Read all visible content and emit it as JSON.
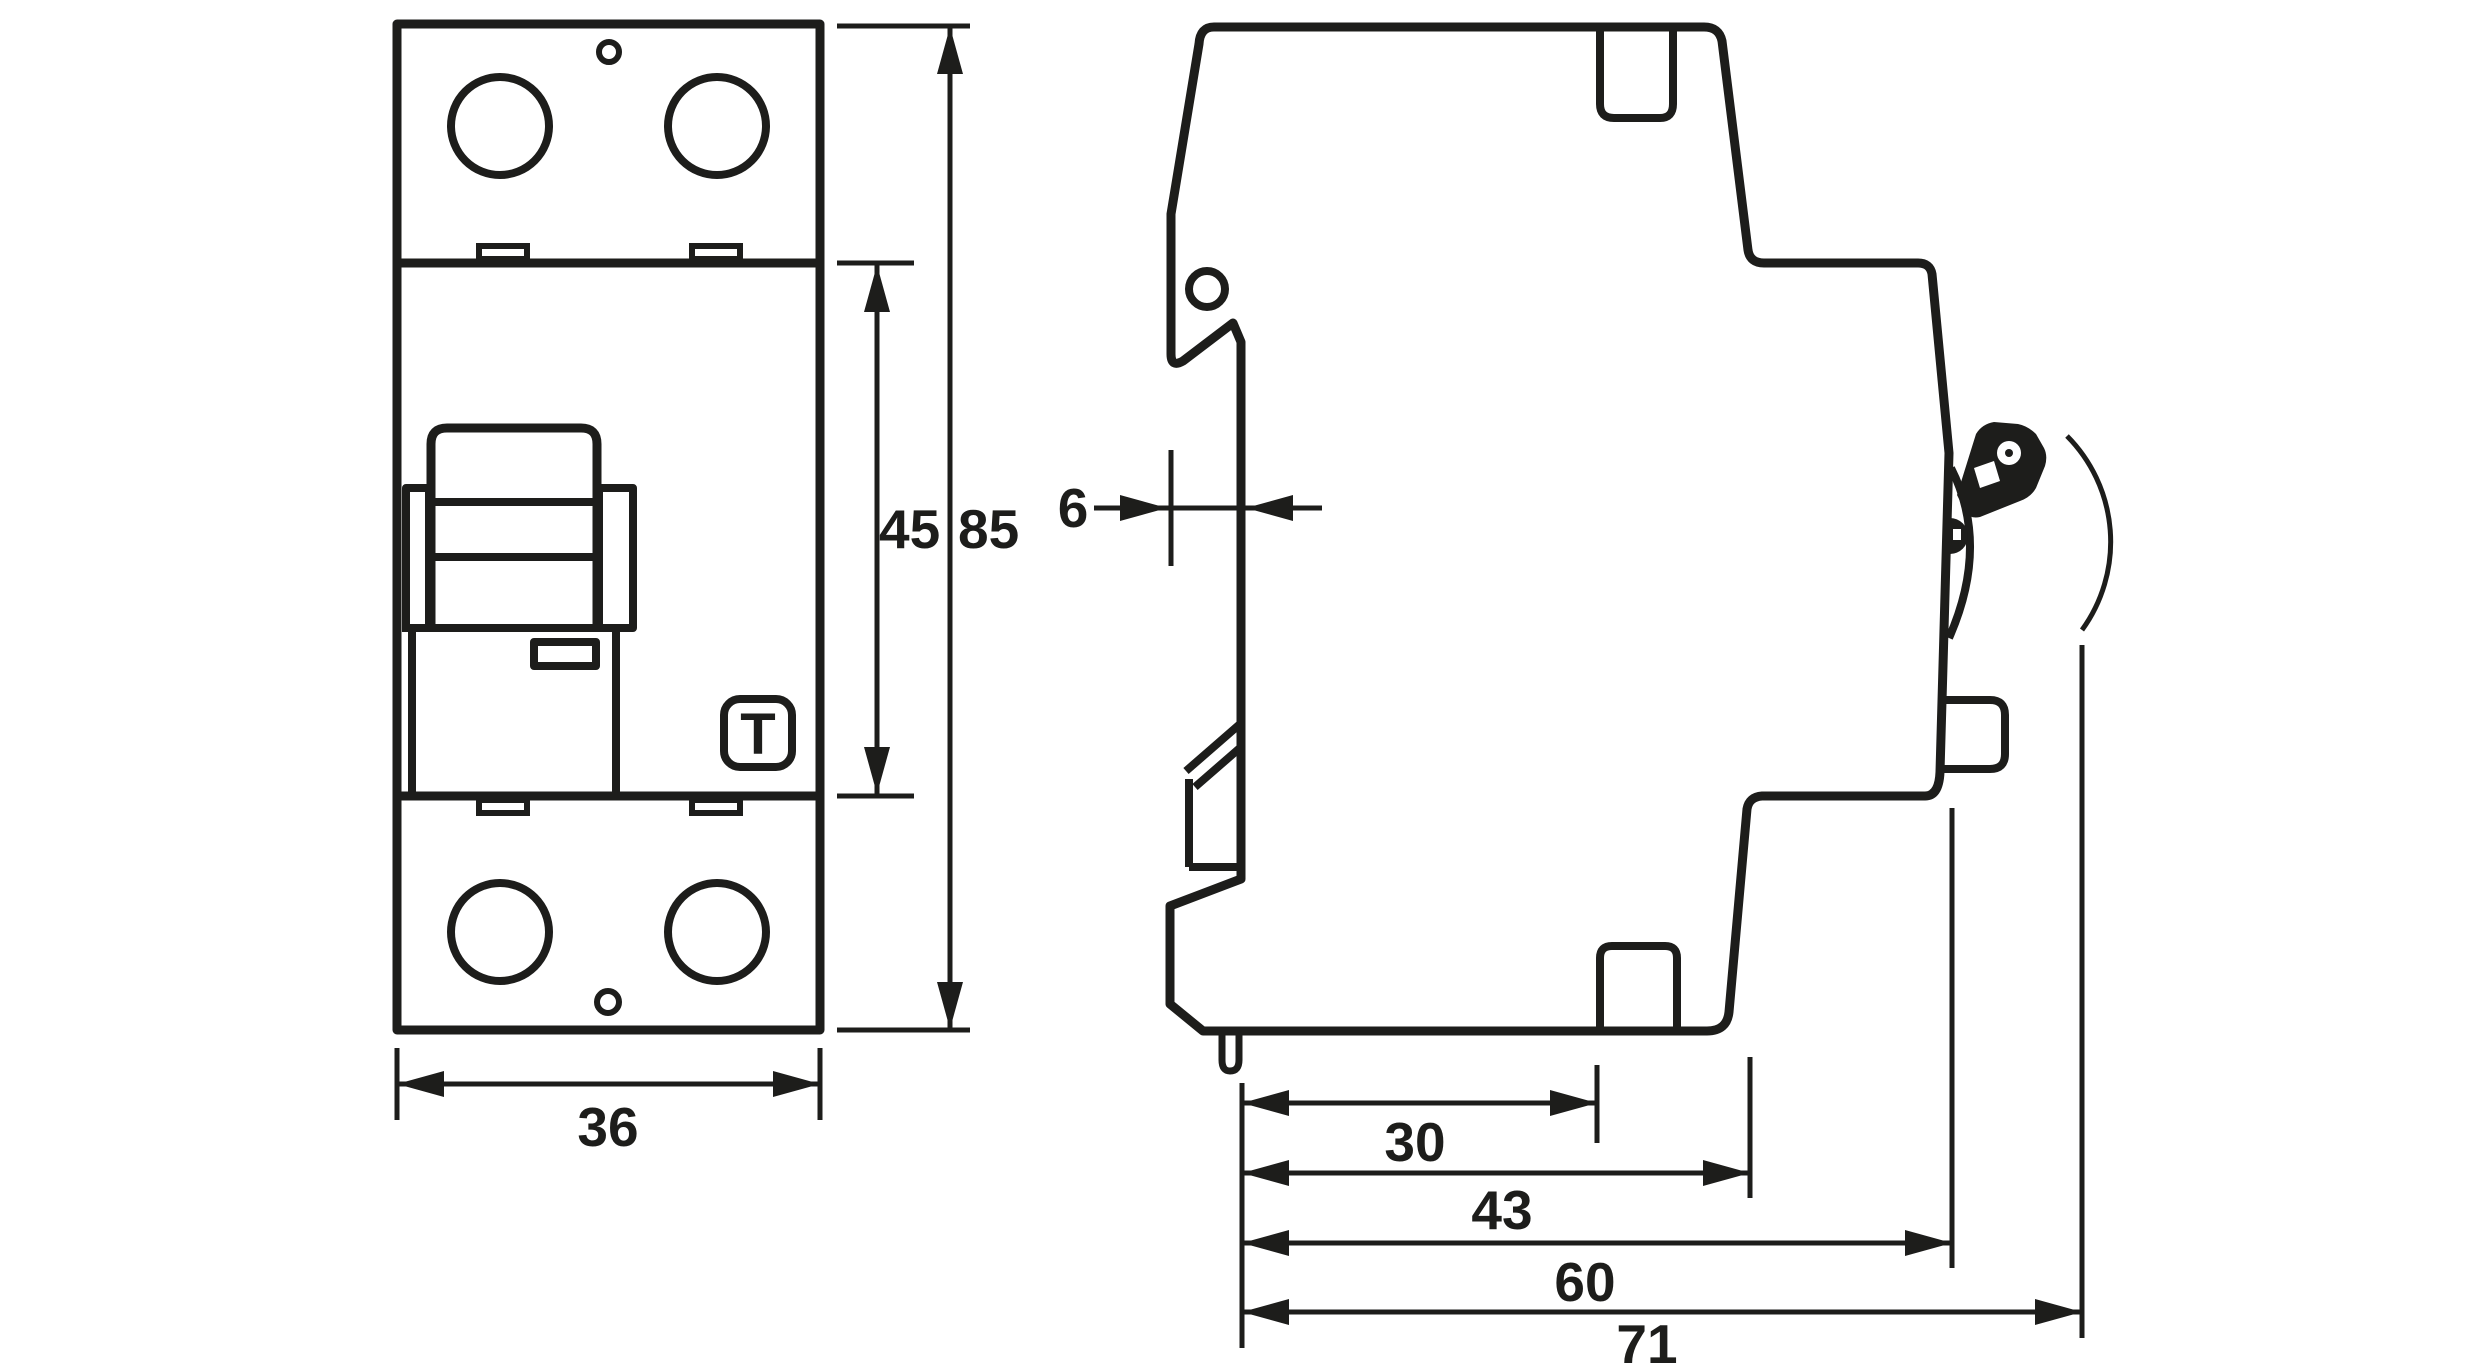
{
  "page": {
    "background": "#ffffff"
  },
  "drawing": {
    "line_color": "#1d1d1b",
    "front_view": {
      "test_button_label": "T"
    },
    "dimensions_mm": {
      "front_width": "36",
      "front_body_height": "45",
      "front_total_height": "85",
      "side_rail_recess_depth": "6",
      "side_depth_30": "30",
      "side_depth_43": "43",
      "side_depth_60": "60",
      "side_total_depth": "71"
    }
  }
}
